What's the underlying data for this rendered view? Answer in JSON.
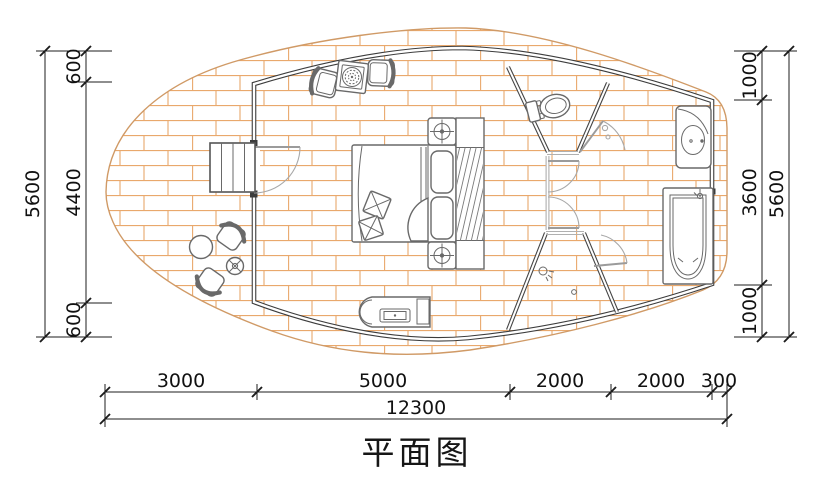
{
  "title": "平面图",
  "dimensions": {
    "left": {
      "segments": [
        "600",
        "4400",
        "600"
      ],
      "overall": "5600"
    },
    "right": {
      "segments": [
        "1000",
        "3600",
        "1000"
      ],
      "overall": "5600"
    },
    "bottom": {
      "segments": [
        "3000",
        "5000",
        "2000",
        "2000",
        "300"
      ],
      "overall": "12300"
    }
  },
  "colors": {
    "brick_hatch": "#e9a86c",
    "deck_edge": "#d09a66",
    "wall": "#3c3c3c",
    "furniture_line": "#696969",
    "door_swing": "#9b9b9b",
    "dimension_line": "#1c1c1c",
    "background": "#ffffff"
  },
  "fixtures": [
    "entry-steps",
    "entry-door",
    "outdoor-table",
    "outdoor-chairs",
    "outdoor-stool",
    "armchairs",
    "fire-pit-table",
    "double-bed",
    "pillows",
    "nightstand-lamps",
    "wardrobe",
    "tv-cabinet",
    "toilet",
    "sink-vanity",
    "bathtub",
    "shower-head",
    "floor-drain"
  ]
}
